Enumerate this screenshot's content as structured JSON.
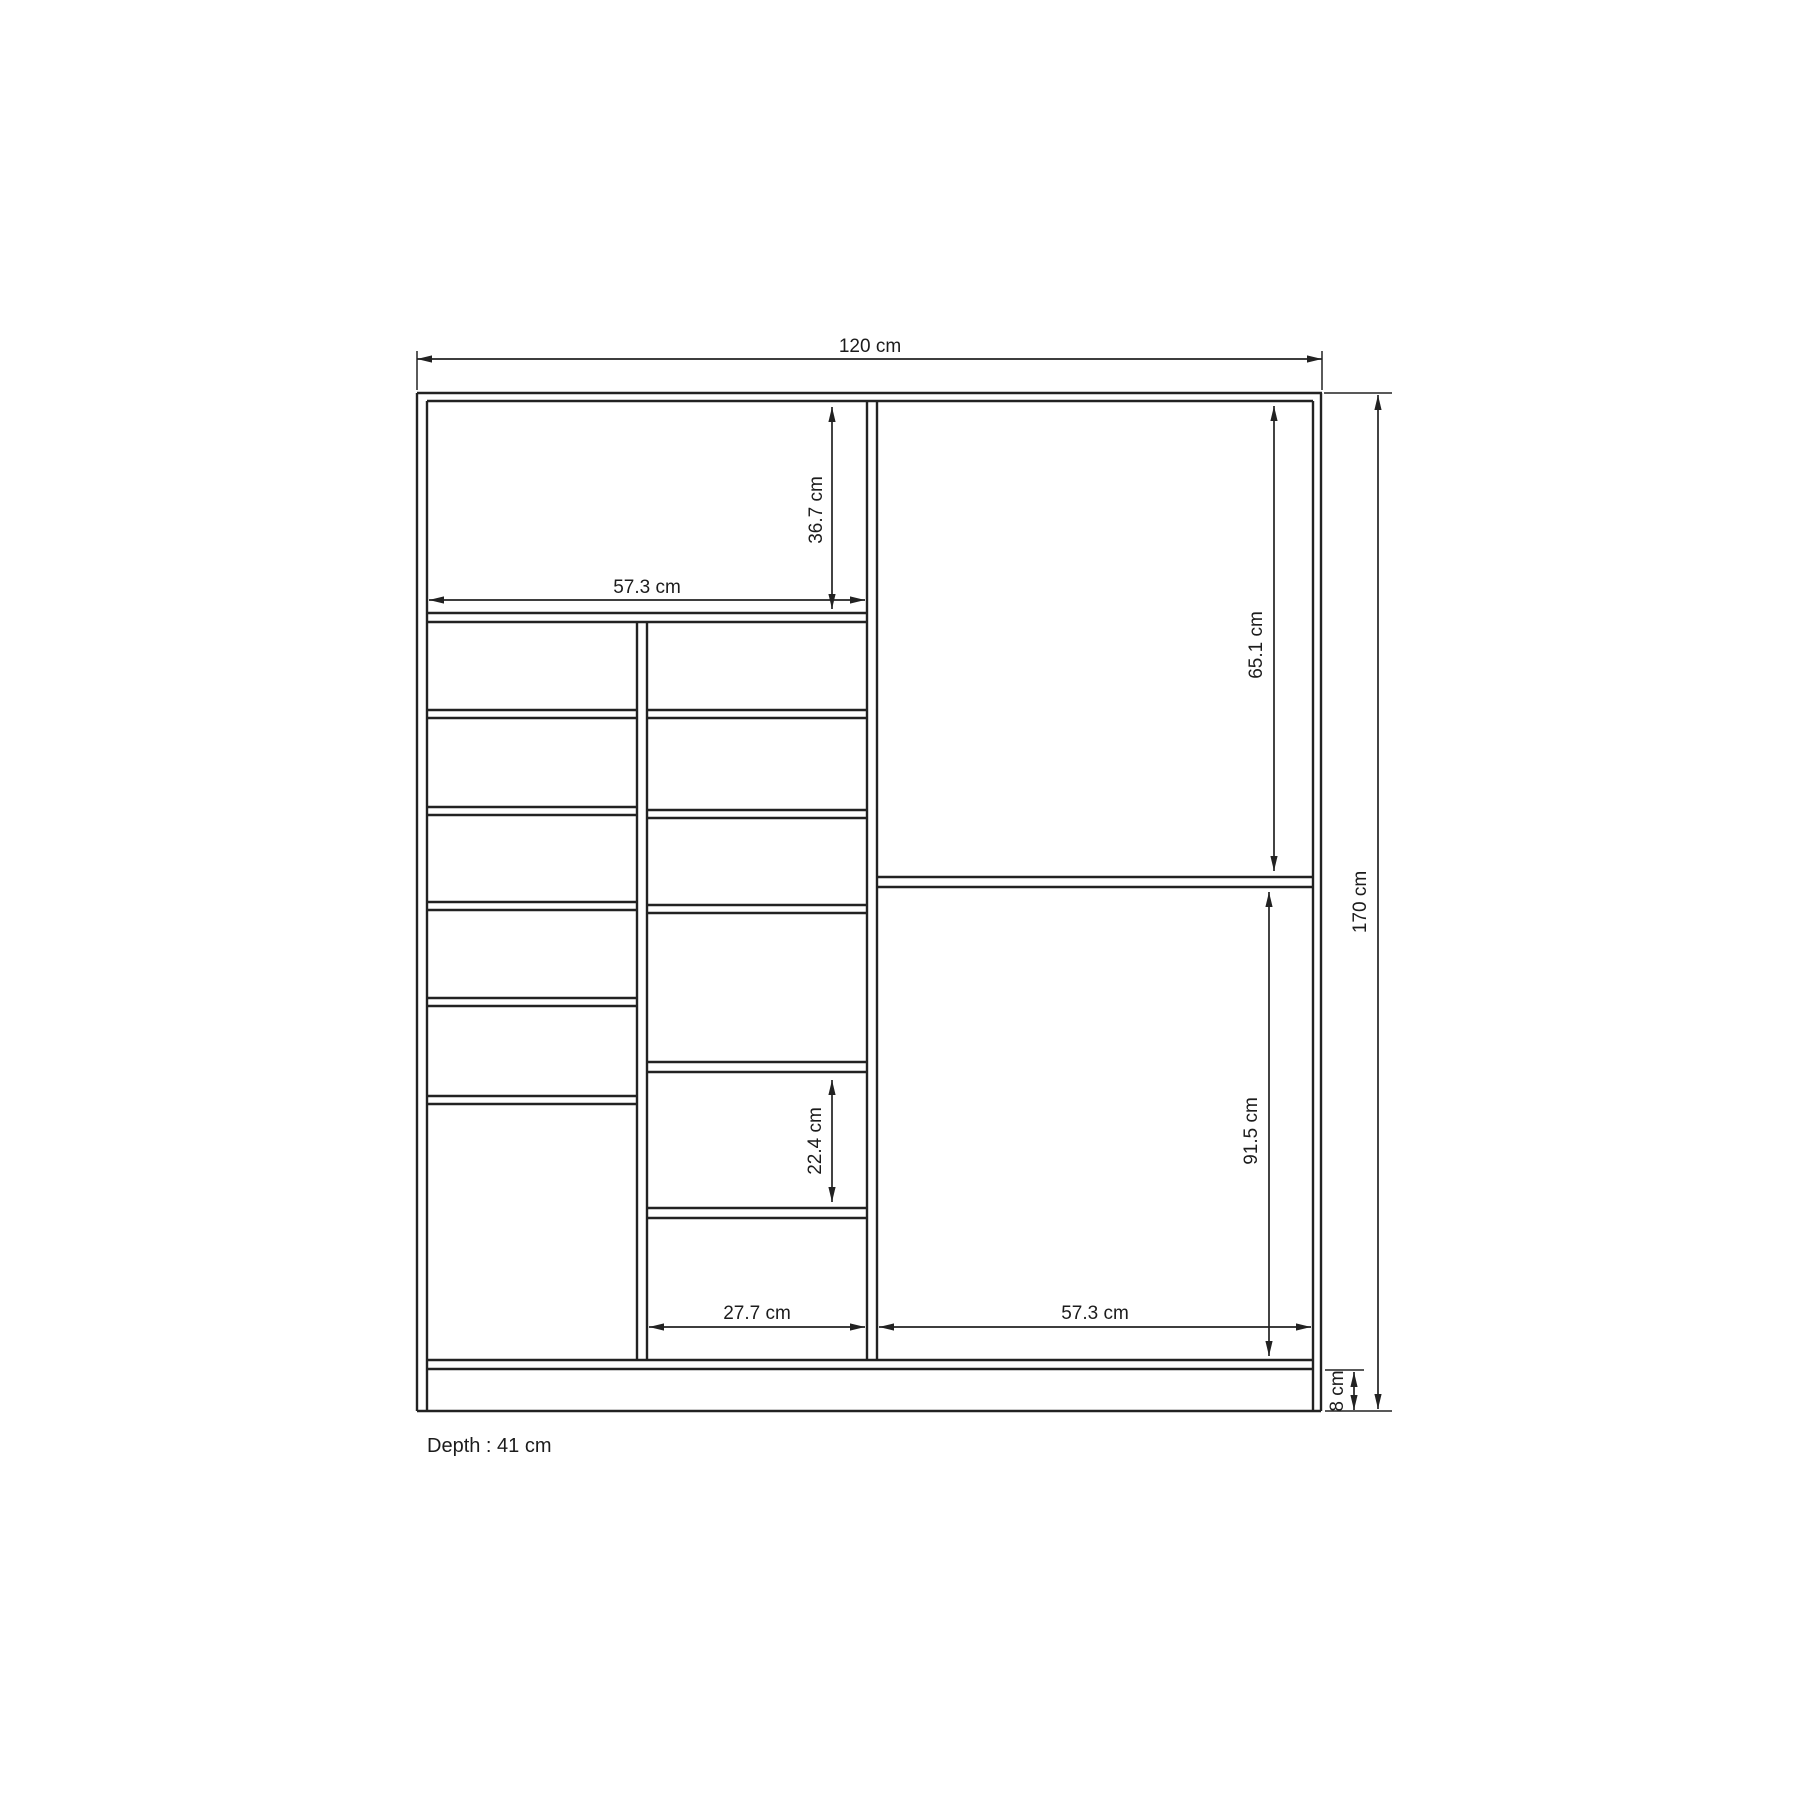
{
  "page": {
    "background": "#ffffff",
    "line_color": "#222222",
    "text_color": "#1c1c1c",
    "depth_note": "Depth : 41 cm"
  },
  "dims": {
    "overall_width": {
      "label": "120 cm",
      "value": 120,
      "unit": "cm"
    },
    "upper_left_width": {
      "label": "57.3 cm",
      "value": 57.3,
      "unit": "cm"
    },
    "upper_left_height": {
      "label": "36.7 cm",
      "value": 36.7,
      "unit": "cm"
    },
    "right_upper_height": {
      "label": "65.1 cm",
      "value": 65.1,
      "unit": "cm"
    },
    "cubby_height": {
      "label": "22.4 cm",
      "value": 22.4,
      "unit": "cm"
    },
    "right_lower_height": {
      "label": "91.5 cm",
      "value": 91.5,
      "unit": "cm"
    },
    "cubby_width": {
      "label": "27.7 cm",
      "value": 27.7,
      "unit": "cm"
    },
    "right_lower_width": {
      "label": "57.3 cm",
      "value": 57.3,
      "unit": "cm"
    },
    "overall_height": {
      "label": "170 cm",
      "value": 170,
      "unit": "cm"
    },
    "base_height": {
      "label": "8 cm",
      "value": 8,
      "unit": "cm"
    }
  }
}
